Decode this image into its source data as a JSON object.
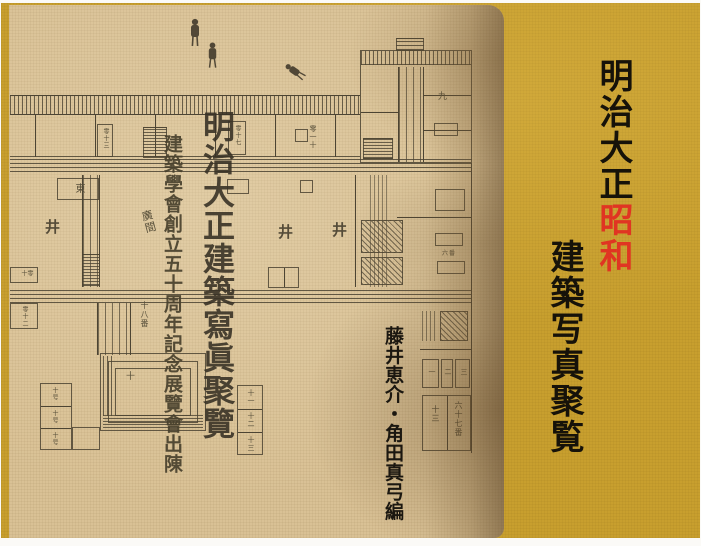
{
  "cover": {
    "background_color": "#c89f2e",
    "accent_red": "#e03522",
    "text_color": "#161209",
    "title_part_black": "明治大正",
    "title_part_red": "昭和",
    "title_line2": "建築写真聚覧",
    "editors": "藤井恵介・角田真弓編"
  },
  "drawing": {
    "paper_color": "#d9c195",
    "ink_color": "#4c4433",
    "plan_title": "明治大正建築寫眞聚覽",
    "plan_caption": "建築學會創立五十周年記念展覽會出陳",
    "annotations": [
      {
        "text": "東"
      },
      {
        "text": "零十三"
      },
      {
        "text": "零十七"
      },
      {
        "text": "零一十"
      },
      {
        "text": "九"
      },
      {
        "text": "廣間"
      },
      {
        "text": "十八番"
      },
      {
        "text": "井"
      },
      {
        "text": "六番"
      },
      {
        "text": "十"
      },
      {
        "text": "十号"
      },
      {
        "text": "十一"
      },
      {
        "text": "十二"
      },
      {
        "text": "十三"
      },
      {
        "text": "一"
      },
      {
        "text": "二"
      },
      {
        "text": "三"
      },
      {
        "text": "六十七番"
      },
      {
        "text": "零十"
      },
      {
        "text": "零十二"
      }
    ]
  }
}
